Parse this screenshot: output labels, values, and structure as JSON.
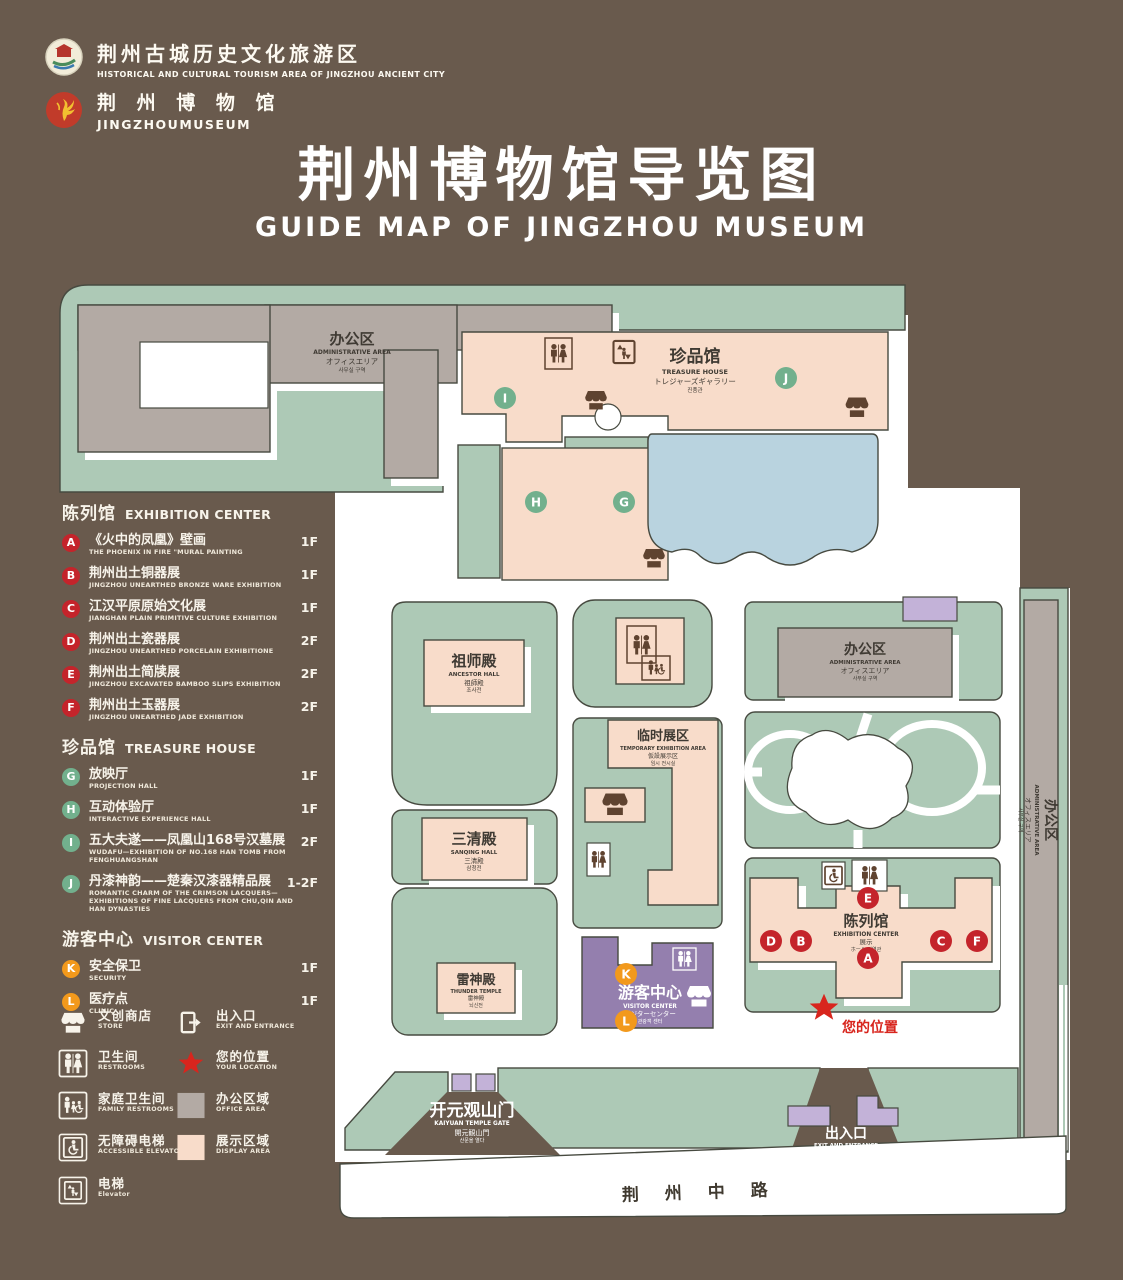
{
  "colors": {
    "background": "#695a4d",
    "campus_green": "#adc9b6",
    "path_white": "#ffffff",
    "display_pink": "#f8dcca",
    "office_gray": "#b3aaa4",
    "lake_blue": "#b9d3df",
    "visitor_purple": "#947fae",
    "entrance_purple": "#c3b2d8",
    "badge_red": "#c4242b",
    "badge_green": "#72b08d",
    "badge_orange": "#f2991c",
    "location_red": "#d8251d"
  },
  "letters": {
    "A": "A",
    "B": "B",
    "C": "C",
    "D": "D",
    "E": "E",
    "F": "F",
    "G": "G",
    "H": "H",
    "I": "I",
    "J": "J",
    "K": "K",
    "L": "L"
  },
  "header": {
    "org": {
      "zh": "荆州古城历史文化旅游区",
      "en": "HISTORICAL AND CULTURAL TOURISM AREA OF JINGZHOU ANCIENT CITY"
    },
    "museum": {
      "zh": "荆 州 博 物 馆",
      "en": "JINGZHOUMUSEUM"
    },
    "title": {
      "zh": "荆州博物馆导览图",
      "en": "GUIDE MAP OF JINGZHOU MUSEUM"
    }
  },
  "legend": {
    "sections": [
      {
        "zh": "陈列馆",
        "en": "EXHIBITION CENTER",
        "items": [
          {
            "badge": "A",
            "zh": "《火中的凤凰》壁画",
            "en": "THE PHOENIX IN FIRE \"MURAL PAINTING",
            "floor": "1F"
          },
          {
            "badge": "B",
            "zh": "荆州出土铜器展",
            "en": "JINGZHOU UNEARTHED BRONZE WARE EXHIBITION",
            "floor": "1F"
          },
          {
            "badge": "C",
            "zh": "江汉平原原始文化展",
            "en": "JIANGHAN PLAIN PRIMITIVE CULTURE EXHIBITION",
            "floor": "1F"
          },
          {
            "badge": "D",
            "zh": "荆州出土瓷器展",
            "en": "JINGZHOU UNEARTHED PORCELAIN EXHIBITIONE",
            "floor": "2F"
          },
          {
            "badge": "E",
            "zh": "荆州出土简牍展",
            "en": "JINGZHOU EXCAVATED BAMBOO SLIPS EXHIBITION",
            "floor": "2F"
          },
          {
            "badge": "F",
            "zh": "荆州出土玉器展",
            "en": "JINGZHOU UNEARTHED JADE EXHIBITION",
            "floor": "2F"
          }
        ]
      },
      {
        "zh": "珍品馆",
        "en": "TREASURE HOUSE",
        "items": [
          {
            "badge": "G",
            "zh": "放映厅",
            "en": "PROJECTION HALL",
            "floor": "1F"
          },
          {
            "badge": "H",
            "zh": "互动体验厅",
            "en": "INTERACTIVE EXPERIENCE HALL",
            "floor": "1F"
          },
          {
            "badge": "I",
            "zh": "五大夫遂——凤凰山168号汉墓展",
            "en": "WUDAFU—EXHIBITION OF NO.168 HAN TOMB FROM FENGHUANGSHAN",
            "floor": "2F"
          },
          {
            "badge": "J",
            "zh": "丹漆神韵——楚秦汉漆器精品展",
            "en": "ROMANTIC CHARM OF THE CRIMSON LACQUERS—EXHIBITIONS OF FINE LACQUERS FROM CHU,QIN AND HAN DYNASTIES",
            "floor": "1-2F"
          }
        ]
      },
      {
        "zh": "游客中心",
        "en": "VISITOR CENTER",
        "items": [
          {
            "badge": "K",
            "zh": "安全保卫",
            "en": "SECURITY",
            "floor": "1F"
          },
          {
            "badge": "L",
            "zh": "医疗点",
            "en": "CLINIC",
            "floor": "1F"
          }
        ]
      }
    ]
  },
  "symbols": {
    "store": {
      "zh": "文创商店",
      "en": "STORE"
    },
    "restrooms": {
      "zh": "卫生间",
      "en": "RESTROOMS"
    },
    "family_restrooms": {
      "zh": "家庭卫生间",
      "en": "FAMILY RESTROOMS"
    },
    "accessible_elevator": {
      "zh": "无障碍电梯",
      "en": "ACCESSIBLE ELEVATOR"
    },
    "elevator": {
      "zh": "电梯",
      "en": "Elevator"
    },
    "exit": {
      "zh": "出入口",
      "en": "EXIT AND ENTRANCE"
    },
    "location": {
      "zh": "您的位置",
      "en": "YOUR LOCATION"
    },
    "office": {
      "zh": "办公区域",
      "en": "OFFICE AREA"
    },
    "display": {
      "zh": "展示区域",
      "en": "DISPLAY AREA"
    }
  },
  "map": {
    "admin": {
      "zh": "办公区",
      "en": "ADMINISTRATIVE AREA",
      "jp": "オフィスエリア",
      "kr": "사무실 구역"
    },
    "treasure": {
      "zh": "珍品馆",
      "en": "TREASURE HOUSE",
      "jp": "トレジャーズギャラリー",
      "kr": "진품관"
    },
    "ancestor": {
      "zh": "祖师殿",
      "en": "ANCESTOR HALL",
      "jp": "祖師殿",
      "kr": "조사전"
    },
    "sanqing": {
      "zh": "三清殿",
      "en": "SANQING HALL",
      "jp": "三清殿",
      "kr": "삼청전"
    },
    "temporary": {
      "zh": "临时展区",
      "en": "TEMPORARY EXHIBITION AREA",
      "jp": "仮設展示区",
      "kr": "임시 전시실"
    },
    "thunder": {
      "zh": "雷神殿",
      "en": "THUNDER TEMPLE",
      "jp": "雷神殿",
      "kr": "뇌신전"
    },
    "visitor": {
      "zh": "游客中心",
      "en": "VISITOR CENTER",
      "jp": "ビジターセンター",
      "kr": "관광객 센터"
    },
    "exhibition": {
      "zh": "陈列馆",
      "en": "EXHIBITION CENTER",
      "jp": "展示",
      "kr": "ホール 진열관"
    },
    "exit": {
      "zh": "出入口",
      "en": "EXIT AND ENTRANCE",
      "jp": "出入口",
      "kr": "출입구"
    },
    "gate": {
      "zh": "开元观山门",
      "en": "KAIYUAN TEMPLE GATE",
      "jp": "開元観山門",
      "kr": "산문을 열다"
    },
    "road": "荆 州 中 路",
    "your_location": "您的位置"
  }
}
